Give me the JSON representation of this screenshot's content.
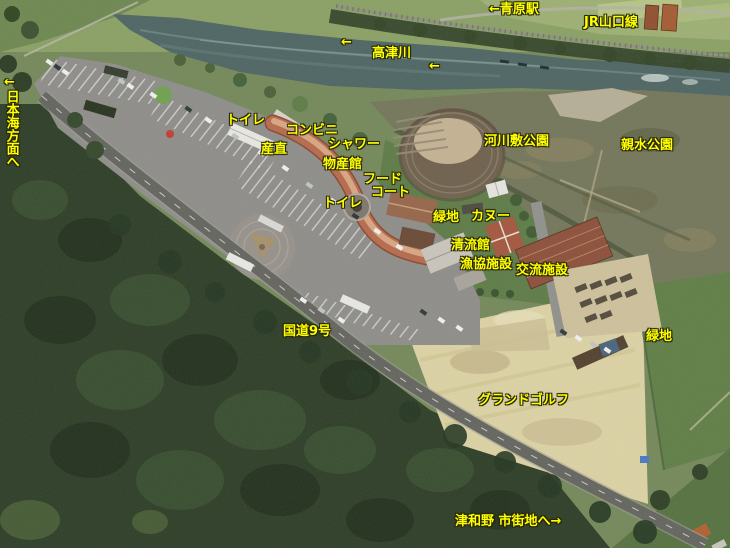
{
  "palette": {
    "label_yellow": "#ffff00",
    "label_outline": "#26260a",
    "river_teal": "#4e6563",
    "forest_dark_green": "#2d3d26",
    "parking_gray": "#8e8d89",
    "roof_terracotta": "#b5694a",
    "roof_brick_red": "#a4563e",
    "golf_sand": "#dcd2a4",
    "field_green": "#5f7e46"
  },
  "labels": {
    "aohara_station": "←青原駅",
    "jr_yamaguchi_line": "JR山口線",
    "takatsu_river": "高津川",
    "arrow_river_upstream_1": "←",
    "arrow_river_upstream_2": "←",
    "arrow_sea_direction": "←",
    "nihonkai_direction": "日本海方面へ",
    "toilet_1": "トイレ",
    "convenience_store": "コンビニ",
    "farm_stand": "産直",
    "shower": "シャワー",
    "bussankan": "物産館",
    "food_court_line1": "フード",
    "food_court_line2": "コート",
    "toilet_2": "トイレ",
    "riverside_park": "河川敷公園",
    "shinsui_park": "親水公園",
    "green_area_1": "緑地",
    "canoe": "カヌー",
    "seiryukan": "清流館",
    "fishery_coop_facility": "漁協施設",
    "exchange_facility": "交流施設",
    "route_9": "国道9号",
    "green_area_2": "緑地",
    "ground_golf": "グランドゴルフ",
    "tsuwano_city_direction": "津和野 市街地へ→"
  }
}
